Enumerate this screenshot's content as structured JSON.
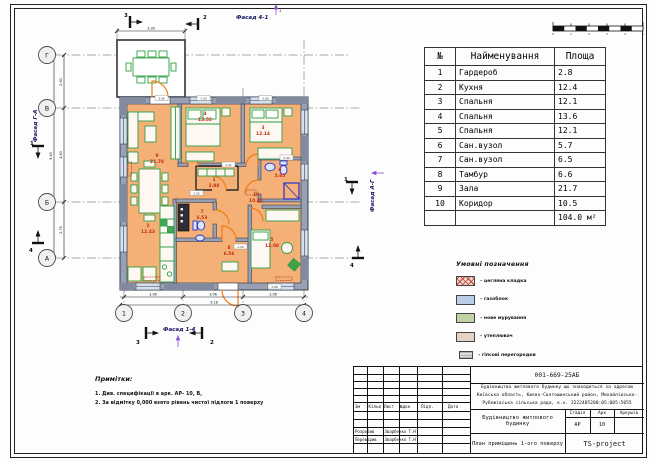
{
  "plan": {
    "facades": {
      "top": "Фасад 4-1",
      "bottom": "Фасад 1-4",
      "left": "Фасад Г-А",
      "right": "Фасад А-Г",
      "top_ref": "1"
    },
    "axes": {
      "h": [
        "Г",
        "В",
        "Б",
        "А"
      ],
      "v": [
        "1",
        "2",
        "3",
        "4"
      ]
    },
    "sections": {
      "top": [
        "3",
        "2"
      ],
      "bottom": [
        "3",
        "2"
      ],
      "left": [
        "1",
        "4"
      ],
      "right": [
        "1",
        "4"
      ]
    },
    "rooms": [
      {
        "num": "9",
        "area": "21.78"
      },
      {
        "num": "4",
        "area": "13.55"
      },
      {
        "num": "3",
        "area": "12.14"
      },
      {
        "num": "1",
        "area": "2.88"
      },
      {
        "num": "10",
        "area": "10.48"
      },
      {
        "num": "6",
        "area": "5.65"
      },
      {
        "num": "2",
        "area": "12.43"
      },
      {
        "num": "7",
        "area": "6.53"
      },
      {
        "num": "8",
        "area": "6.56"
      },
      {
        "num": "5",
        "area": "12.08"
      }
    ],
    "dims": {
      "bottom": [
        "3.06",
        "3.06",
        "3.06"
      ],
      "bottom_total": "9.18",
      "left": [
        "2.60",
        "4.60",
        "2.75"
      ],
      "left_total": "9.45",
      "porch": "3.30",
      "inner": [
        "3.06",
        "1.50",
        "3.06",
        "1.41",
        "0.90",
        "2.05",
        "1.20",
        "3.06"
      ]
    },
    "scale_ticks": [
      "0",
      "1",
      "2",
      "3",
      "4",
      "5"
    ]
  },
  "table": {
    "headers": [
      "№",
      "Найменування",
      "Площа"
    ],
    "rows": [
      {
        "num": "1",
        "name": "Гардероб",
        "area": "2.8"
      },
      {
        "num": "2",
        "name": "Кухня",
        "area": "12.4"
      },
      {
        "num": "3",
        "name": "Спальня",
        "area": "12.1"
      },
      {
        "num": "4",
        "name": "Спальня",
        "area": "13.6"
      },
      {
        "num": "5",
        "name": "Спальня",
        "area": "12.1"
      },
      {
        "num": "6",
        "name": "Сан.вузол",
        "area": "5.7"
      },
      {
        "num": "7",
        "name": "Сан.вузол",
        "area": "6.5"
      },
      {
        "num": "8",
        "name": "Тамбур",
        "area": "6.6"
      },
      {
        "num": "9",
        "name": "Зала",
        "area": "21.7"
      },
      {
        "num": "10",
        "name": "Коридор",
        "area": "10.5"
      }
    ],
    "total": "104.0 м²"
  },
  "legend": {
    "title": "Умовні позначення",
    "items": [
      "– цегляна кладка",
      "– газоблок",
      "– нове мурування",
      "– утеплювач",
      "– гіпсові перегородки"
    ]
  },
  "notes": {
    "title": "Примітки:",
    "lines": [
      "1. Див. специфікації в арк. АР- 10, В,",
      "2. За відмітку 0,000 взято рівень чистої підлоги 1 поверху"
    ]
  },
  "titleblock": {
    "code": "001-669-25АБ",
    "address_lines": [
      "Будівництво житлового будинку що знаходиться за адресою",
      "Київська область, Києво-Святошинський район, Михайлівсько-",
      "Рубежівська сільська рада, к.н. 3222485200:05:005:5055"
    ],
    "object": "Будівництво житлового будинку",
    "stage_label": "Стадія",
    "sheet_label": "Арк",
    "sheets_label": "Аркушів",
    "stage": "АР",
    "sheet": "10",
    "sheet_title": "План приміщень 1-ого поверху",
    "company": "TS-project",
    "cols": [
      "Зм",
      "Кільк",
      "Лист",
      "№док",
      "Підп.",
      "Дата"
    ],
    "roles": [
      {
        "role": "Розробив",
        "name": "Зварбенко Т.Н"
      },
      {
        "role": "Перевірив",
        "name": "Зварбенко Т.Н"
      }
    ]
  }
}
